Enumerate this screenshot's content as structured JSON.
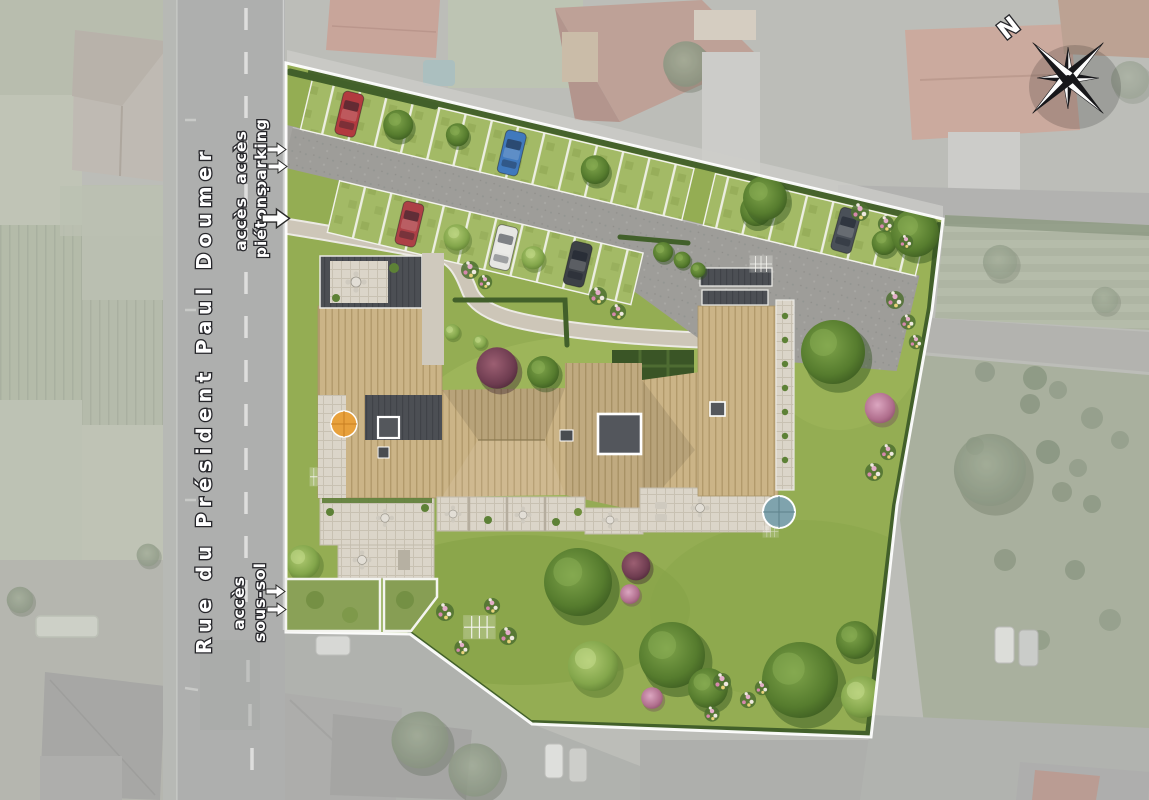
{
  "map": {
    "street": {
      "name": "Rue du Président Paul Doumer"
    },
    "annotations": {
      "parking": {
        "line1": "accès",
        "line2": "parking"
      },
      "pietons": {
        "line1": "accès",
        "line2": "piétons"
      },
      "sous_sol": {
        "line1": "accès",
        "line2": "sous-sol"
      }
    },
    "compass": {
      "north": "N"
    },
    "colors": {
      "site_lawn": "#94ad53",
      "wood_roof": "#cbb487",
      "dark_roof": "#4c4f54",
      "asphalt": "#9e9d99",
      "path": "#cdc6b8",
      "boundary": "#ffffff",
      "hedge": "#46632c",
      "muted_background": "#b2b4ae"
    },
    "cars_parking": [
      {
        "row": "top",
        "color": "#b23a3f"
      },
      {
        "row": "top",
        "color": "#4079bd"
      },
      {
        "row": "right",
        "color": "#4a5058"
      },
      {
        "row": "bottom",
        "color": "#ad4046"
      },
      {
        "row": "bottom",
        "color": "#e6e6e3"
      },
      {
        "row": "bottom",
        "color": "#3c4046"
      }
    ]
  }
}
